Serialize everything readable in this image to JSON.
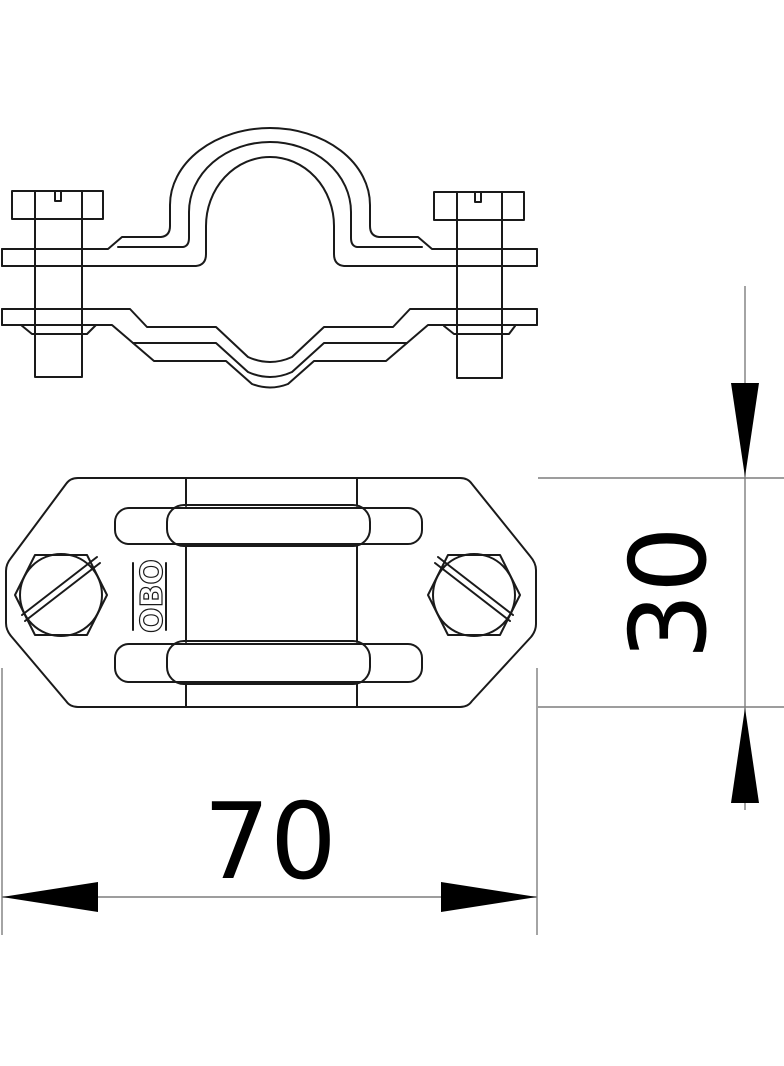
{
  "drawing": {
    "brand_mark": "OBO",
    "dimension_width": "70",
    "dimension_height": "30",
    "colors": {
      "outline": "#1a1a1a",
      "dimension_line": "#7d7d7d",
      "text": "#000000",
      "background": "#ffffff"
    }
  }
}
